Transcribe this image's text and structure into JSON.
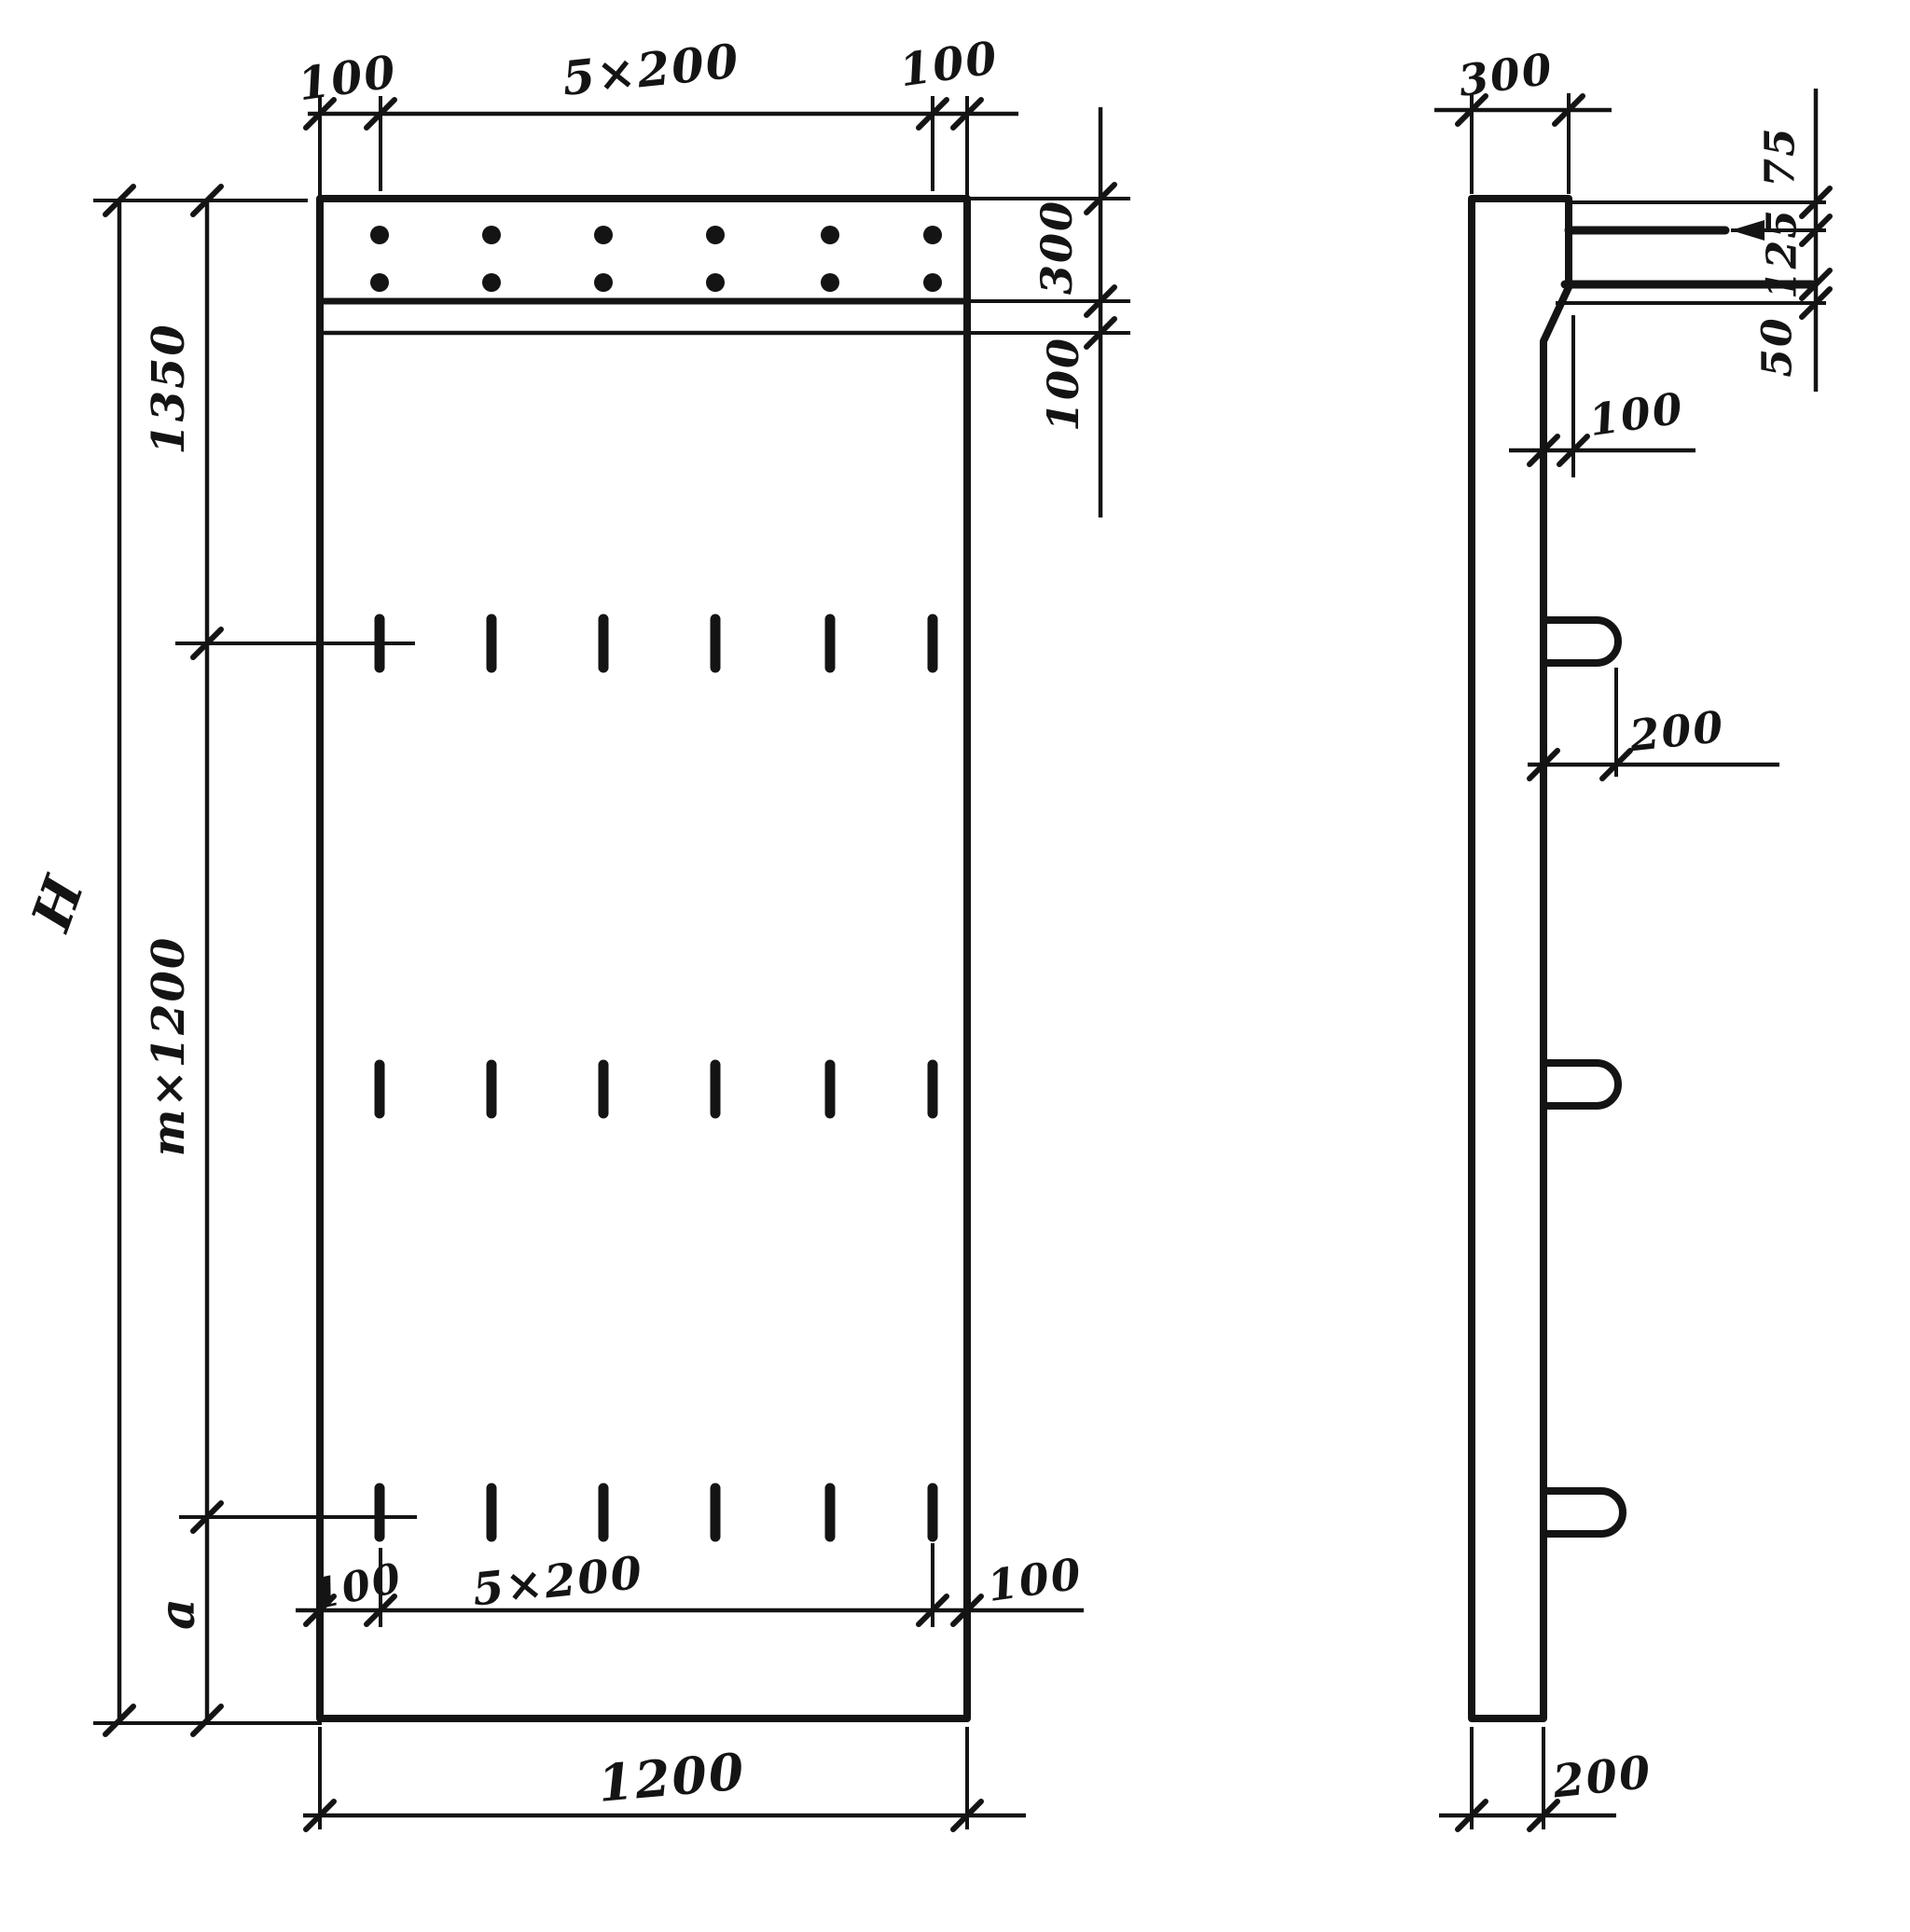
{
  "front_view": {
    "top_dims": {
      "left": "100",
      "center": "5×200",
      "right": "100"
    },
    "right_dims": {
      "band_height": "300",
      "line_offset": "100"
    },
    "left_dims": {
      "top_segment": "1350",
      "middle_segment": "m×1200",
      "bottom_segment": "a",
      "overall_height": "H"
    },
    "bottom_dims": {
      "left": "100",
      "center": "5×200",
      "right": "100",
      "overall_width": "1200"
    }
  },
  "side_view": {
    "top_width": "300",
    "right_dims": {
      "top": "75",
      "middle": "125",
      "bottom": "50"
    },
    "step_depth": "100",
    "loop_length": "200",
    "bottom_width": "200"
  }
}
